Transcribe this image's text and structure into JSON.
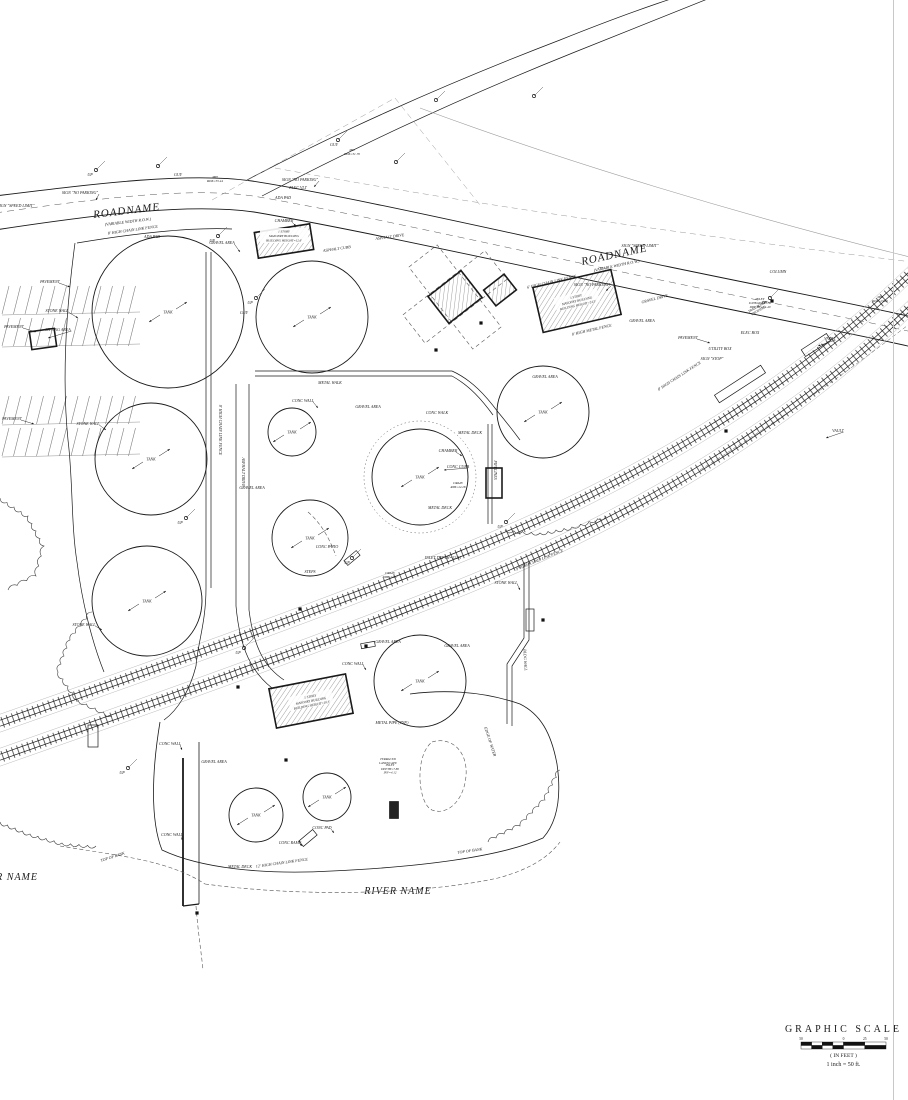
{
  "colors": {
    "ink": "#1a1a1a",
    "mid": "#555555",
    "faint": "#9a9a9a",
    "border": "#c8c8c8"
  },
  "road_labels": [
    {
      "text": "ROADNAME",
      "sub": "(VARIABLE WIDTH R.O.W.)",
      "x": 127,
      "y": 214,
      "rot": -7,
      "fs": 11,
      "subfs": 4
    },
    {
      "text": "ROADNAME",
      "sub": "(VARIABLE WIDTH R.O.W.)",
      "x": 615,
      "y": 258,
      "rot": -12,
      "fs": 11,
      "subfs": 4
    }
  ],
  "river_labels": [
    {
      "text": "RIVER NAME",
      "x": 38,
      "y": 880,
      "anchor": "end",
      "fs": 10
    },
    {
      "text": "RIVER NAME",
      "x": 398,
      "y": 894,
      "anchor": "middle",
      "fs": 10
    }
  ],
  "scale_block": {
    "title": "GRAPHIC SCALE",
    "units": "( IN FEET )",
    "ratio": "1 inch = 50 ft.",
    "ticks": [
      "50",
      "0",
      "25",
      "50"
    ],
    "x": 801,
    "y": 1032,
    "bar_w": 85
  },
  "tanks": [
    {
      "cx": 168,
      "cy": 312,
      "r": 76,
      "label": "TANK"
    },
    {
      "cx": 312,
      "cy": 317,
      "r": 56,
      "label": "TANK"
    },
    {
      "cx": 292,
      "cy": 432,
      "r": 24,
      "label": "TANK"
    },
    {
      "cx": 151,
      "cy": 459,
      "r": 56,
      "label": "TANK"
    },
    {
      "cx": 420,
      "cy": 477,
      "r": 48,
      "label": "TANK",
      "outer": true
    },
    {
      "cx": 543,
      "cy": 412,
      "r": 46,
      "label": "TANK"
    },
    {
      "cx": 147,
      "cy": 601,
      "r": 55,
      "label": "TANK"
    },
    {
      "cx": 310,
      "cy": 538,
      "r": 38,
      "label": "TANK"
    },
    {
      "cx": 420,
      "cy": 681,
      "r": 46,
      "label": "TANK"
    },
    {
      "cx": 256,
      "cy": 815,
      "r": 27,
      "label": "TANK"
    },
    {
      "cx": 327,
      "cy": 797,
      "r": 24,
      "label": "TANK"
    }
  ],
  "buildings": [
    {
      "cx": 284,
      "cy": 241,
      "w": 56,
      "h": 26,
      "rot": -9
    },
    {
      "cx": 455,
      "cy": 297,
      "w": 42,
      "h": 34,
      "rot": -38,
      "canopy": true
    },
    {
      "cx": 500,
      "cy": 290,
      "w": 26,
      "h": 20,
      "rot": -38
    },
    {
      "cx": 577,
      "cy": 301,
      "w": 80,
      "h": 46,
      "rot": -13,
      "label": [
        "1 STORY",
        "MASONRY BUILDING",
        "BUILDING HEIGHT=24.5'"
      ]
    },
    {
      "cx": 311,
      "cy": 701,
      "w": 78,
      "h": 40,
      "rot": -11,
      "label": [
        "1 STORY",
        "MASONRY BUILDING",
        "BUILDING HEIGHT=19.3'"
      ]
    }
  ],
  "building_callout": {
    "lines": [
      "1 STORY",
      "MASONRY BUILDING",
      "BUILDING HEIGHT=12.6'"
    ],
    "x": 284,
    "y": 236
  },
  "platforms": [
    {
      "cx": 740,
      "cy": 384,
      "w": 55,
      "h": 9,
      "rot": -33
    },
    {
      "cx": 816,
      "cy": 345,
      "w": 30,
      "h": 8,
      "rot": -33
    },
    {
      "cx": 352,
      "cy": 558,
      "w": 16,
      "h": 6,
      "rot": -40
    },
    {
      "cx": 368,
      "cy": 645,
      "w": 14,
      "h": 5,
      "rot": -10
    },
    {
      "cx": 93,
      "cy": 736,
      "w": 10,
      "h": 22,
      "rot": 0
    },
    {
      "cx": 394,
      "cy": 810,
      "w": 9,
      "h": 17,
      "rot": 0,
      "fill": true
    },
    {
      "cx": 43,
      "cy": 339,
      "w": 25,
      "h": 18,
      "rot": -8,
      "bold": true
    },
    {
      "cx": 494,
      "cy": 483,
      "w": 16,
      "h": 30,
      "rot": 0,
      "bold": true
    },
    {
      "cx": 308,
      "cy": 838,
      "w": 18,
      "h": 7,
      "rot": -40
    },
    {
      "cx": 530,
      "cy": 620,
      "w": 8,
      "h": 22,
      "rot": 0
    }
  ],
  "marks": [
    [
      436,
      350
    ],
    [
      481,
      323
    ],
    [
      300,
      609
    ],
    [
      366,
      646
    ],
    [
      238,
      687
    ],
    [
      726,
      431
    ],
    [
      772,
      301
    ],
    [
      543,
      620
    ],
    [
      197,
      913
    ],
    [
      286,
      760
    ]
  ],
  "poles": [
    [
      218,
      236
    ],
    [
      96,
      170
    ],
    [
      256,
      298
    ],
    [
      186,
      518
    ],
    [
      128,
      768
    ],
    [
      352,
      558
    ],
    [
      506,
      522
    ],
    [
      770,
      298
    ],
    [
      244,
      648
    ],
    [
      338,
      140
    ],
    [
      396,
      162
    ],
    [
      436,
      100
    ],
    [
      534,
      96
    ],
    [
      158,
      166
    ]
  ],
  "linework": {
    "roads": [
      {
        "d": "M -5,196 C 100,183 190,172 252,181 C 360,198 520,236 670,267 C 790,292 870,307 912,317",
        "cls": "ink",
        "w": 0.9
      },
      {
        "d": "M -5,230 C 100,214 190,203 254,212 C 360,230 520,266 670,297 C 790,322 870,337 912,347",
        "cls": "ink",
        "w": 0.9
      },
      {
        "d": "M -5,213 C 100,198 190,187 253,196 C 360,214 520,251 670,282 C 790,307 870,322 912,332",
        "cls": "dash",
        "w": 0.5
      },
      {
        "d": "M 247,180 C 330,136 440,86 560,40 C 640,8 690,-8 715,-14",
        "cls": "ink",
        "w": 0.7
      },
      {
        "d": "M 262,196 C 350,150 460,98 575,52 C 655,20 705,0 725,-8",
        "cls": "ink",
        "w": 0.7
      },
      {
        "d": "M 275,168 C 480,206 700,236 912,262",
        "cls": "dashfaint",
        "w": 0.5
      },
      {
        "d": "M 420,108 C 560,160 740,215 914,258",
        "cls": "faint",
        "w": 0.6
      },
      {
        "d": "M 212,200 L 395,98",
        "cls": "dashfaint",
        "w": 0.5
      },
      {
        "d": "M 395,98 L 480,205",
        "cls": "dashfaint",
        "w": 0.5
      }
    ],
    "rails": [
      {
        "d": "M -8,726 C 140,674 300,618 455,556 C 625,488 790,392 914,270"
      },
      {
        "d": "M -8,760 C 140,708 300,652 455,590 C 625,522 790,426 914,304"
      }
    ],
    "solid": [
      {
        "d": "M 75,243 C 66,310 62,380 68,440 C 73,480 71,525 77,562 C 82,602 92,642 104,672",
        "w": 0.7
      },
      {
        "d": "M 77,243 C 130,234 190,227 232,229",
        "w": 0.7
      },
      {
        "d": "M 255,371 L 452,371",
        "w": 0.7
      },
      {
        "d": "M 255,376 L 452,376",
        "w": 0.7
      },
      {
        "d": "M 452,371 C 472,380 486,396 498,412 C 508,424 514,432 520,440",
        "w": 0.7
      },
      {
        "d": "M 452,376 C 470,386 482,400 493,415",
        "w": 0.7
      },
      {
        "d": "M 488,424 L 488,524",
        "w": 0.7
      },
      {
        "d": "M 492,424 L 492,524",
        "w": 0.7
      },
      {
        "d": "M 206,252 L 206,588 C 206,622 198,642 196,666",
        "w": 0.7
      },
      {
        "d": "M 211,252 L 211,588",
        "w": 0.7
      },
      {
        "d": "M 236,384 L 236,606 C 240,650 252,672 272,688",
        "w": 0.7
      },
      {
        "d": "M 249,384 L 249,610 C 254,650 266,668 284,680",
        "w": 0.7
      },
      {
        "d": "M 524,562 L 524,638 L 507,664 L 507,724",
        "w": 0.7
      },
      {
        "d": "M 529,562 L 529,640 L 512,666 L 512,726",
        "w": 0.7
      },
      {
        "d": "M 183,758 L 183,906",
        "w": 1.8
      },
      {
        "d": "M 199,742 L 199,904",
        "w": 0.8
      },
      {
        "d": "M 183,906 L 199,904",
        "w": 1.2
      },
      {
        "d": "M 160,722 C 152,770 150,820 162,850 C 200,868 262,875 332,871 C 420,867 500,857 543,838 C 559,820 561,792 557,764 C 551,732 540,714 520,704 C 480,690 440,690 410,694",
        "w": 0.8
      },
      {
        "d": "M 196,666 C 190,690 178,710 164,720",
        "w": 0.7
      }
    ],
    "dashed": [
      {
        "d": "M 205,884 C 300,897 420,895 498,878 C 528,870 548,858 560,842",
        "w": 0.6
      },
      {
        "d": "M 60,846 C 120,856 168,860 205,884",
        "w": 0.6
      },
      {
        "d": "M 196,906 C 198,932 201,950 203,970",
        "w": 0.6
      },
      {
        "d": "M 700,470 C 780,420 850,370 912,322",
        "w": 0.5
      },
      {
        "d": "M 432,742 C 452,736 468,752 466,776 C 464,800 448,816 432,810 C 418,804 414,756 432,742",
        "w": 0.6
      },
      {
        "d": "M 308,512 C 322,524 330,540 336,556",
        "w": 0.6
      }
    ],
    "treelines": [
      {
        "pts": [
          [
            92,
            612
          ],
          [
            70,
            640
          ],
          [
            58,
            672
          ],
          [
            78,
            700
          ],
          [
            112,
            716
          ]
        ]
      },
      {
        "pts": [
          [
            0,
            822
          ],
          [
            30,
            834
          ],
          [
            62,
            843
          ],
          [
            96,
            846
          ]
        ]
      },
      {
        "pts": [
          [
            505,
            530
          ],
          [
            540,
            533
          ],
          [
            572,
            527
          ],
          [
            606,
            516
          ]
        ]
      },
      {
        "pts": [
          [
            0,
            498
          ],
          [
            28,
            516
          ],
          [
            44,
            546
          ],
          [
            36,
            576
          ],
          [
            8,
            590
          ]
        ]
      },
      {
        "pts": [
          [
            560,
            770
          ],
          [
            545,
            800
          ],
          [
            520,
            826
          ],
          [
            488,
            842
          ]
        ]
      }
    ],
    "parking": [
      {
        "x": 2,
        "y": 286,
        "n": 12,
        "gap": 11.5,
        "len": 28,
        "slant": 7
      },
      {
        "x": 2,
        "y": 318,
        "n": 12,
        "gap": 11.5,
        "len": 28,
        "slant": 7
      },
      {
        "x": 2,
        "y": 396,
        "n": 12,
        "gap": 11.5,
        "len": 28,
        "slant": 7
      },
      {
        "x": 2,
        "y": 428,
        "n": 12,
        "gap": 11.5,
        "len": 28,
        "slant": 7
      }
    ]
  },
  "annotations": [
    {
      "t": "PAVEMENT",
      "x": 14,
      "y": 328,
      "lead": [
        36,
        332
      ]
    },
    {
      "t": "PAVEMENT",
      "x": 12,
      "y": 420,
      "lead": [
        34,
        424
      ]
    },
    {
      "t": "PAVEMENT",
      "x": 50,
      "y": 283,
      "lead": [
        70,
        287
      ]
    },
    {
      "t": "PAVEMENT",
      "x": 688,
      "y": 339,
      "lead": [
        710,
        343
      ]
    },
    {
      "t": "GRAVEL AREA",
      "x": 222,
      "y": 244,
      "lead": [
        240,
        252
      ]
    },
    {
      "t": "GRAVEL AREA",
      "x": 368,
      "y": 408
    },
    {
      "t": "GRAVEL AREA",
      "x": 252,
      "y": 489
    },
    {
      "t": "GRAVEL AREA",
      "x": 388,
      "y": 643
    },
    {
      "t": "GRAVEL AREA",
      "x": 545,
      "y": 378
    },
    {
      "t": "GRAVEL AREA",
      "x": 642,
      "y": 322
    },
    {
      "t": "GRAVEL AREA",
      "x": 214,
      "y": 763
    },
    {
      "t": "GRAVEL AREA",
      "x": 457,
      "y": 647
    },
    {
      "t": "GRAVEL DRIVE",
      "x": 655,
      "y": 300,
      "r": -15
    },
    {
      "t": "STONE WALL",
      "x": 57,
      "y": 312,
      "lead": [
        78,
        318
      ]
    },
    {
      "t": "STONE WALL",
      "x": 88,
      "y": 425,
      "lead": [
        106,
        430
      ]
    },
    {
      "t": "STONE WALL",
      "x": 84,
      "y": 626,
      "lead": [
        102,
        630
      ]
    },
    {
      "t": "STONE WALL",
      "x": 506,
      "y": 584,
      "lead": [
        520,
        590
      ]
    },
    {
      "t": "CONC WALL",
      "x": 303,
      "y": 402,
      "lead": [
        318,
        408
      ]
    },
    {
      "t": "CONC WALL",
      "x": 353,
      "y": 665,
      "lead": [
        366,
        670
      ]
    },
    {
      "t": "CONC WALL",
      "x": 170,
      "y": 745,
      "lead": [
        182,
        750
      ]
    },
    {
      "t": "CONC WALL",
      "x": 172,
      "y": 836,
      "lead": [
        182,
        840
      ]
    },
    {
      "t": "CONC PAD",
      "x": 322,
      "y": 829,
      "lead": [
        334,
        833
      ]
    },
    {
      "t": "CONC RAMP",
      "x": 290,
      "y": 844,
      "lead": [
        302,
        846
      ]
    },
    {
      "t": "CONC CURB",
      "x": 458,
      "y": 468,
      "lead": [
        444,
        470
      ]
    },
    {
      "t": "CONC WALK",
      "x": 437,
      "y": 414
    },
    {
      "t": "METAL WALK",
      "x": 330,
      "y": 384
    },
    {
      "t": "METAL DECK",
      "x": 470,
      "y": 434
    },
    {
      "t": "METAL DECK",
      "x": 440,
      "y": 509
    },
    {
      "t": "METAL DECK",
      "x": 240,
      "y": 868
    },
    {
      "t": "METAL PIPE (TYP.)",
      "x": 392,
      "y": 724
    },
    {
      "t": "CHAMBER",
      "x": 448,
      "y": 452,
      "lead": [
        462,
        456
      ]
    },
    {
      "t": "CHAMBER",
      "x": 284,
      "y": 222,
      "lead": [
        296,
        226
      ]
    },
    {
      "t": "PIPELINES",
      "x": 494,
      "y": 470,
      "r": 90
    },
    {
      "t": "ASPHALT DRIVE",
      "x": 242,
      "y": 472,
      "r": 90
    },
    {
      "t": "8' HIGH CHAIN LINK FENCE",
      "x": 219,
      "y": 430,
      "r": 90
    },
    {
      "t": "ASPHALT CURB",
      "x": 337,
      "y": 250,
      "r": -8
    },
    {
      "t": "ASPHALT DRIVE",
      "x": 390,
      "y": 238,
      "r": -8
    },
    {
      "t": "8' HIGH CHAIN LINK FENCE",
      "x": 133,
      "y": 231,
      "r": -8
    },
    {
      "t": "8' HIGH CHAIN LINK FENCE",
      "x": 680,
      "y": 377,
      "r": -33
    },
    {
      "t": "9' HIGH CHAIN LINK FENCE",
      "x": 540,
      "y": 561,
      "r": -22
    },
    {
      "t": "12' HIGH CHAIN LINK FENCE",
      "x": 282,
      "y": 864,
      "r": -8
    },
    {
      "t": "6' HIGH CHAIN LINK FENCE",
      "x": 552,
      "y": 283,
      "r": -13
    },
    {
      "t": "8' HIGH METAL FENCE",
      "x": 592,
      "y": 331,
      "r": -13
    },
    {
      "t": "SIGN \"NO PARKING\"",
      "x": 80,
      "y": 194,
      "lead": [
        96,
        200
      ]
    },
    {
      "t": "SIGN \"NO PARKING\"",
      "x": 300,
      "y": 181,
      "lead": [
        314,
        187
      ]
    },
    {
      "t": "SIGN \"NO PARKING\"",
      "x": 592,
      "y": 286,
      "lead": [
        606,
        291
      ]
    },
    {
      "t": "SIGN \"SPEED LIMIT\"",
      "x": 16,
      "y": 207
    },
    {
      "t": "SIGN \"SPEED LIMIT\"",
      "x": 640,
      "y": 247
    },
    {
      "t": "SIGN \"STOP\"",
      "x": 712,
      "y": 360
    },
    {
      "t": "UTILITY BOX",
      "x": 720,
      "y": 350
    },
    {
      "t": "ELEC BOX",
      "x": 750,
      "y": 334
    },
    {
      "t": "ELEC VLT",
      "x": 298,
      "y": 189
    },
    {
      "t": "VAULT",
      "x": 830,
      "y": 340,
      "lead": [
        818,
        346
      ]
    },
    {
      "t": "VAULT",
      "x": 838,
      "y": 432,
      "lead": [
        826,
        438
      ]
    },
    {
      "t": "INLET DEPTH=22.81",
      "x": 443,
      "y": 559
    },
    {
      "t": "INLET|D.HEAD=33.50|DEPTH=32.40",
      "x": 760,
      "y": 300,
      "fs": 3.4
    },
    {
      "t": "INLET|DEPTH=7.80|INV=4.12",
      "x": 390,
      "y": 766,
      "fs": 3.2
    },
    {
      "t": "MH|RIM=33.44",
      "x": 215,
      "y": 178,
      "fs": 3.4
    },
    {
      "t": "MH|RIM=31.70",
      "x": 352,
      "y": 151,
      "fs": 3.4
    },
    {
      "t": "MH|RIM=23.82",
      "x": 880,
      "y": 298,
      "fs": 3.4
    },
    {
      "t": "DRAIN|RIM=22.28",
      "x": 458,
      "y": 484,
      "fs": 3.2
    },
    {
      "t": "DRAIN|RIM=22.87",
      "x": 390,
      "y": 574,
      "fs": 3.2
    },
    {
      "t": "COLUMN",
      "x": 778,
      "y": 273
    },
    {
      "t": "TRAIL ROAD|CROSSING",
      "x": 757,
      "y": 308,
      "r": -30,
      "fs": 3.4
    },
    {
      "t": "EDGE OF WATER",
      "x": 489,
      "y": 742,
      "r": 72
    },
    {
      "t": "TOP OF BANK",
      "x": 113,
      "y": 858,
      "r": -18
    },
    {
      "t": "TOP OF BANK",
      "x": 470,
      "y": 852,
      "r": -8
    },
    {
      "t": "CONC PATIO",
      "x": 327,
      "y": 548
    },
    {
      "t": "STEPS",
      "x": 310,
      "y": 573
    },
    {
      "t": "BLDG WALL",
      "x": 524,
      "y": 660,
      "r": 87
    },
    {
      "t": "ADA PAD",
      "x": 152,
      "y": 238
    },
    {
      "t": "ADA PAD",
      "x": 283,
      "y": 199
    },
    {
      "t": "SITTING AREA",
      "x": 58,
      "y": 331,
      "lead": [
        48,
        338
      ]
    },
    {
      "t": "TERRACED|LANDSCAPE",
      "x": 388,
      "y": 760,
      "fs": 3.2
    },
    {
      "t": "UP",
      "x": 212,
      "y": 242
    },
    {
      "t": "UP",
      "x": 90,
      "y": 176
    },
    {
      "t": "UP",
      "x": 250,
      "y": 304
    },
    {
      "t": "UP",
      "x": 180,
      "y": 524
    },
    {
      "t": "UP",
      "x": 122,
      "y": 774
    },
    {
      "t": "UP",
      "x": 347,
      "y": 564
    },
    {
      "t": "UP",
      "x": 500,
      "y": 528
    },
    {
      "t": "UP",
      "x": 764,
      "y": 304
    },
    {
      "t": "UP",
      "x": 238,
      "y": 654
    },
    {
      "t": "GUY",
      "x": 178,
      "y": 176
    },
    {
      "t": "GUY",
      "x": 334,
      "y": 146
    },
    {
      "t": "GUY",
      "x": 244,
      "y": 314
    }
  ]
}
